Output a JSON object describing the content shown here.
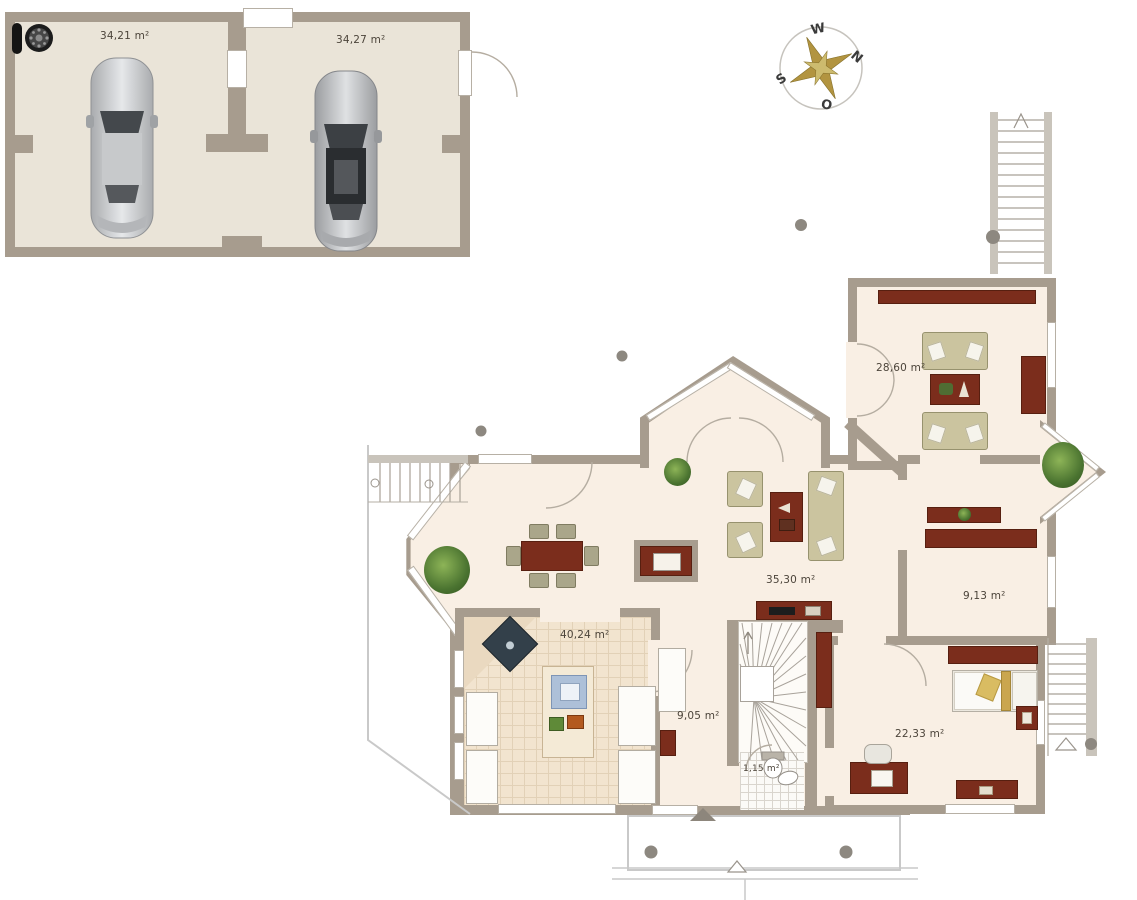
{
  "plan_title": "ground-floor-plan-with-double-garage",
  "garage": {
    "bay_left": "34,21 m²",
    "bay_right": "34,27 m²"
  },
  "rooms": {
    "sitting_room": "28,60 m²",
    "living_room": "35,30 m²",
    "corridor": "9,13 m²",
    "kitchen": "40,24 m²",
    "hall": "9,05 m²",
    "wc": "1,15 m²",
    "bedroom": "22,33 m²"
  },
  "compass": {
    "top": "W",
    "right": "N",
    "bottom": "O",
    "left": "S"
  },
  "colors": {
    "wall": "#a79c8e",
    "floor": "#f9efe4",
    "garage_floor": "#eae4d8",
    "furniture_wood": "#7b2d1c",
    "sofa": "#cbc49f",
    "plant": "#5d8f3c",
    "outline_gray": "#c9c9c9"
  }
}
